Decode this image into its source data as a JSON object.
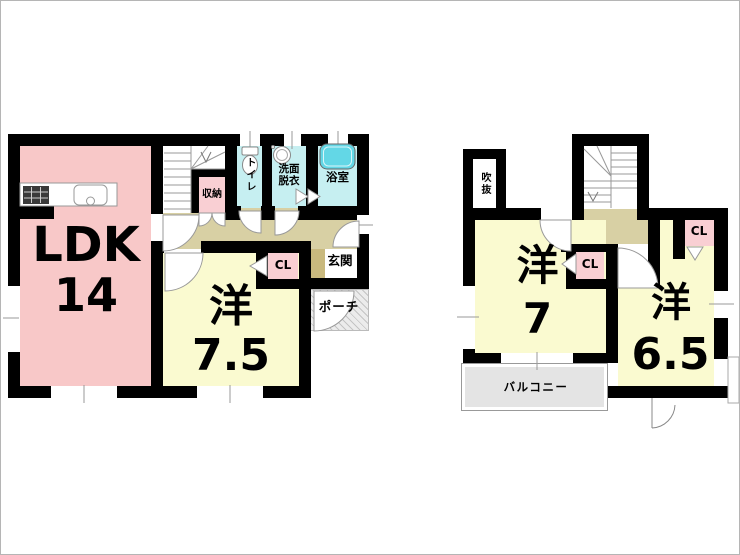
{
  "floor1": {
    "ldk_label": "LDK",
    "ldk_size": "14",
    "room_label": "洋",
    "room_size": "7.5",
    "storage_label": "収納",
    "toilet_label": "トイレ",
    "washroom_label": "洗面\n脱衣",
    "bath_label": "浴室",
    "closet_label": "CL",
    "entrance_label": "玄関",
    "porch_label": "ポーチ"
  },
  "floor2": {
    "room_left_label": "洋",
    "room_left_size": "7",
    "room_right_label": "洋",
    "room_right_size": "6.5",
    "void_label": "吹抜",
    "closet_mid_label": "CL",
    "closet_right_label": "CL",
    "balcony_label": "バルコニー"
  },
  "colors": {
    "room_pink": "#f8c8c8",
    "room_yellow": "#fafad0",
    "wet_cyan": "#c6eff1",
    "tub_cyan": "#63d7e6",
    "hall_beige": "#d8d0a4",
    "step_beige": "#c9b97e",
    "closet_pink": "#f9cfd3",
    "balcony_gray": "#e4e4e4",
    "wall_black": "#000000"
  }
}
